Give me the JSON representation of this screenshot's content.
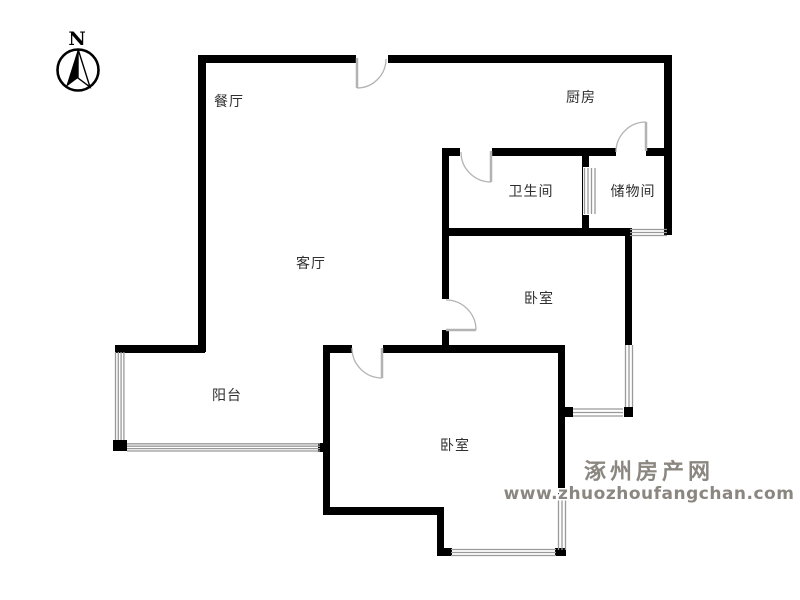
{
  "compass": {
    "label": "N"
  },
  "rooms": [
    {
      "id": "dining",
      "label": "餐厅"
    },
    {
      "id": "kitchen",
      "label": "厨房"
    },
    {
      "id": "bathroom",
      "label": "卫生间"
    },
    {
      "id": "storage",
      "label": "储物间"
    },
    {
      "id": "living",
      "label": "客厅"
    },
    {
      "id": "bedroom-middle",
      "label": "卧室"
    },
    {
      "id": "balcony",
      "label": "阳台"
    },
    {
      "id": "bedroom-bottom",
      "label": "卧室"
    }
  ],
  "watermark": {
    "site_name": "涿州房产网",
    "site_url": "www.zhuozhoufangchan.com"
  },
  "colors": {
    "wall": "#000000",
    "door": "#b3b3b3",
    "window": "#999999",
    "label_text": "#2f2f2f",
    "watermark": "#8b8680",
    "background": "#ffffff"
  }
}
